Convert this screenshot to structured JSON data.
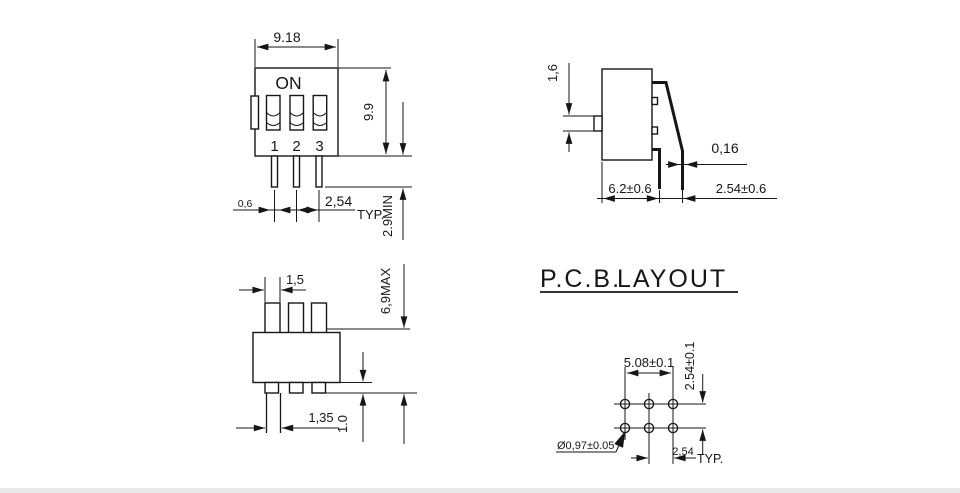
{
  "drawing": {
    "front_view": {
      "on_label": "ON",
      "positions": [
        "1",
        "2",
        "3"
      ],
      "dim_width": "9.18",
      "dim_height": "9.9",
      "dim_pin_width": "0,6",
      "dim_pitch": "2,54",
      "dim_pitch_qualifier": "TYP.",
      "dim_pin_length": "2.9MIN"
    },
    "side_view": {
      "dim_actuator_height": "1,6",
      "dim_lead_thickness": "0,16",
      "dim_body_depth": "6.2±0.6",
      "dim_lead_offset": "2.54±0.6"
    },
    "bottom_view": {
      "dim_actuator_width": "1,5",
      "dim_overall_height": "6,9MAX",
      "dim_pin_width": "1,35",
      "dim_standoff": "1.0"
    },
    "pcb_layout": {
      "title_part1": "P.C.B.",
      "title_part2": "LAYOUT",
      "dim_span": "5.08±0.1",
      "dim_row_pitch": "2.54±0.1",
      "dim_hole_diameter": "Ø0,97±0.05",
      "dim_col_pitch": "2,54",
      "dim_col_pitch_qualifier": "TYP."
    }
  }
}
